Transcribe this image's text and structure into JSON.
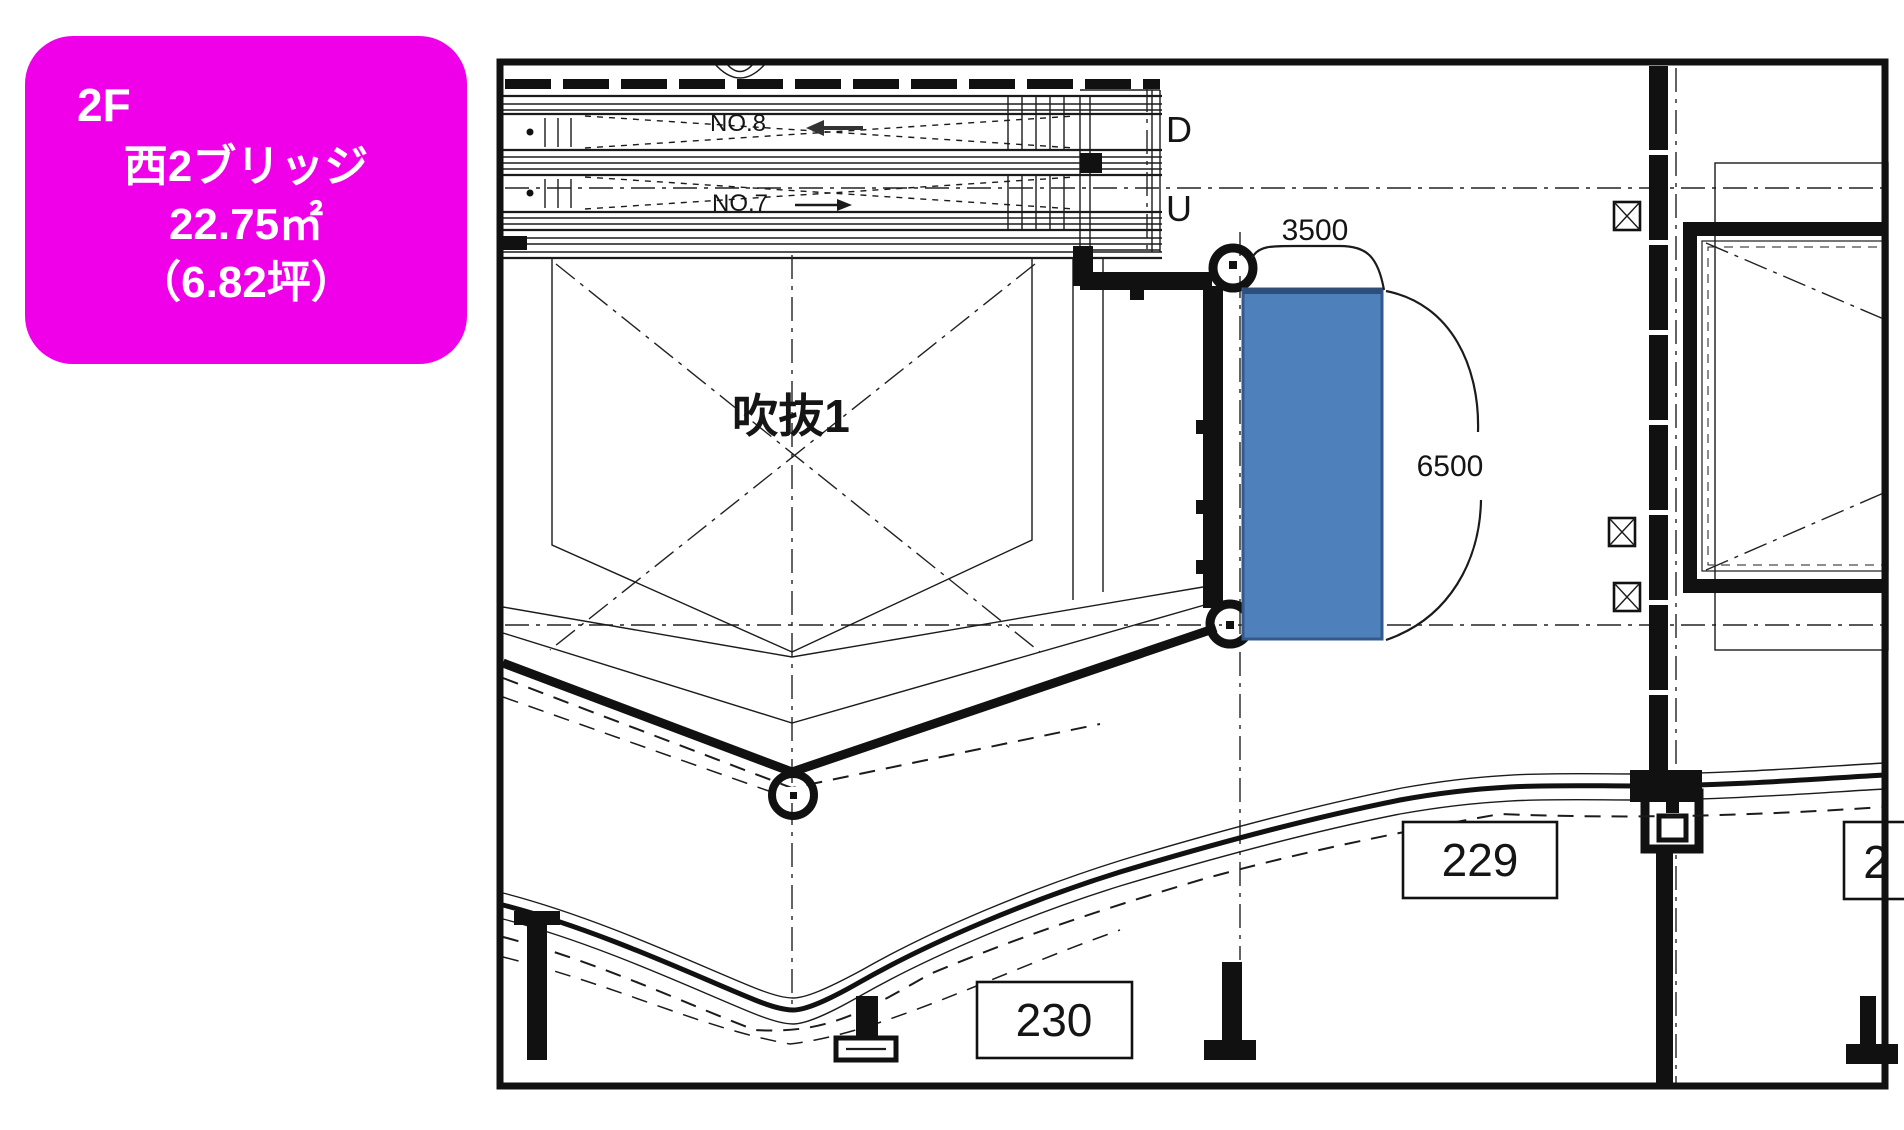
{
  "info_card": {
    "floor": "2F",
    "name": "西2ブリッジ",
    "area": "22.75㎡",
    "area_tsubo": "（6.82坪）",
    "bg": "#F000E8",
    "text_color": "#FFFFFF"
  },
  "plan": {
    "escalators": {
      "no8": "NO.8",
      "no7": "NO.7",
      "down": "D",
      "up": "U"
    },
    "void_label": "吹抜1",
    "dimensions": {
      "width": "3500",
      "height": "6500"
    },
    "rooms": {
      "r229": "229",
      "r230": "230",
      "partial": "2"
    },
    "highlight": {
      "fill": "#4E80BC",
      "border": "#36598C",
      "top_edge": "#2E4F7A"
    }
  }
}
